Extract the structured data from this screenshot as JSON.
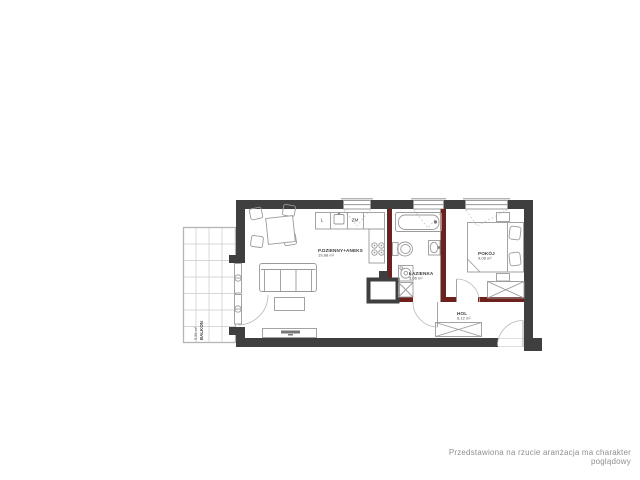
{
  "plan": {
    "rooms": [
      {
        "id": "living",
        "name": "P.DZIENNY+ANEKS",
        "area": "19,88 m²"
      },
      {
        "id": "bathroom",
        "name": "ŁAZIENKA",
        "area": "3,06 m²"
      },
      {
        "id": "bedroom",
        "name": "POKÓJ",
        "area": "9,08 m²"
      },
      {
        "id": "hall",
        "name": "HOL",
        "area": "6,12 m²"
      },
      {
        "id": "balcony",
        "name": "BALKON",
        "area": "5,56 m²"
      }
    ],
    "appliances": {
      "fridge_label": "L",
      "dishwasher_label": "ZM"
    }
  },
  "footer": {
    "disclaimer": "Przedstawiona na rzucie aranżacja ma charakter poglądowy"
  },
  "colors": {
    "wall": "#3f3f3f",
    "accent_wall": "#6e211c"
  }
}
